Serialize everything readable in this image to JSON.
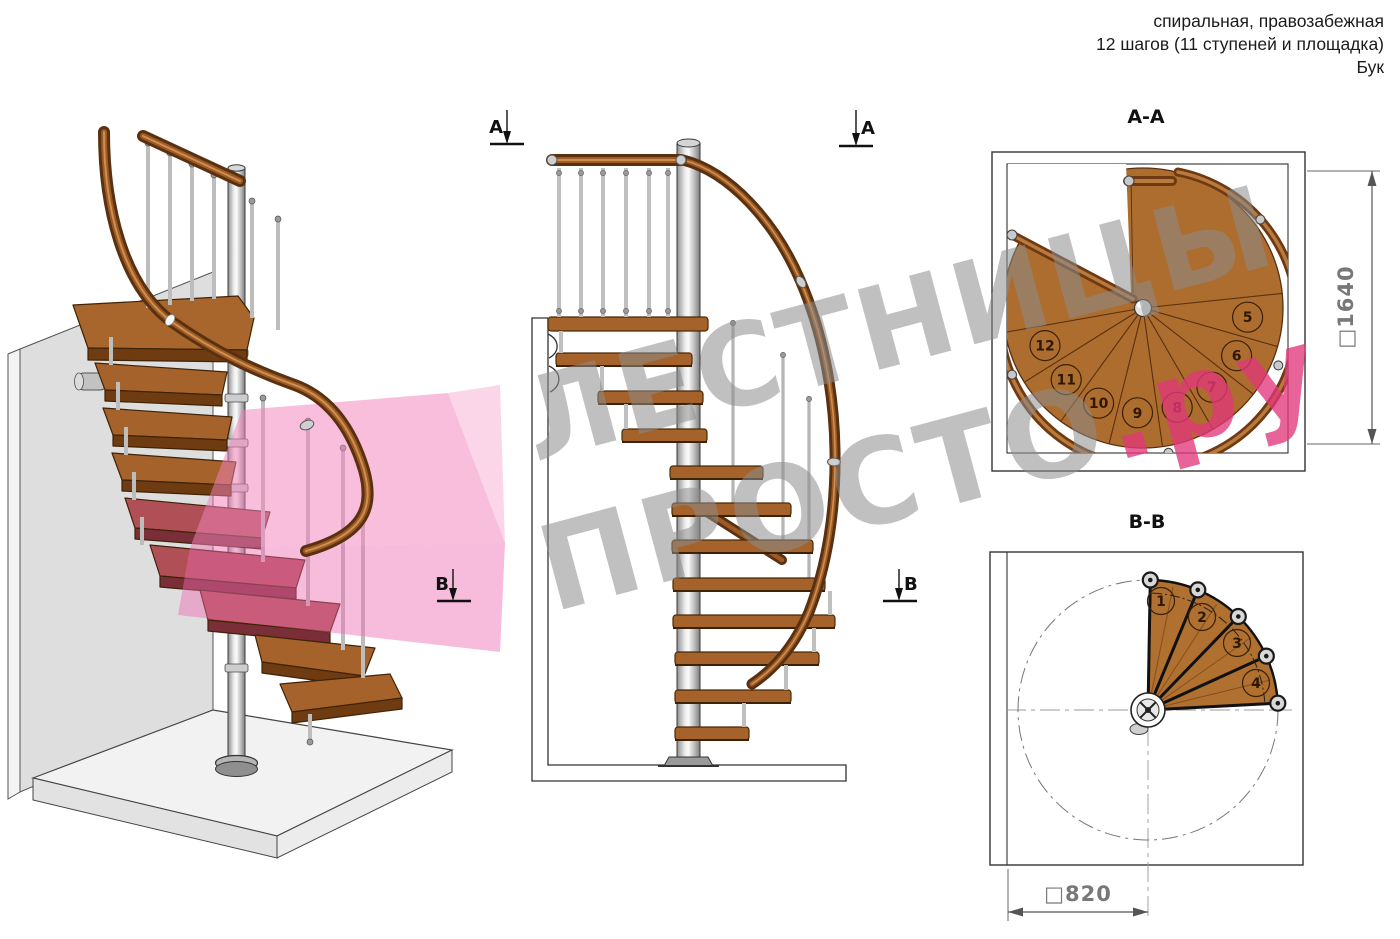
{
  "header": {
    "line1": "спиральная, правозабежная",
    "line2": "12 шагов (11 ступеней и площадка)",
    "line3": "Бук"
  },
  "watermark": {
    "line1": "ЛЕСТНИЦЫ",
    "line2_gray": "ПРОСТО",
    "line2_accent": ".ру",
    "gray_color": "#8c8c8c",
    "accent_color": "#e2377a"
  },
  "section_markers": {
    "a": "А",
    "b": "В"
  },
  "plan_aa": {
    "title": "А-А",
    "dimension_label": "□1640",
    "steps": [
      "5",
      "6",
      "7",
      "8",
      "9",
      "10",
      "11",
      "12"
    ]
  },
  "plan_bb": {
    "title": "В-В",
    "dimension_label": "□820",
    "steps": [
      "1",
      "2",
      "3",
      "4"
    ]
  },
  "palette": {
    "wood": "#a5622a",
    "wood_dark": "#6f3c12",
    "rail": "#5f3210",
    "metal": "#c6c6c6",
    "section_plane": "#ee69af",
    "line": "#333333"
  }
}
